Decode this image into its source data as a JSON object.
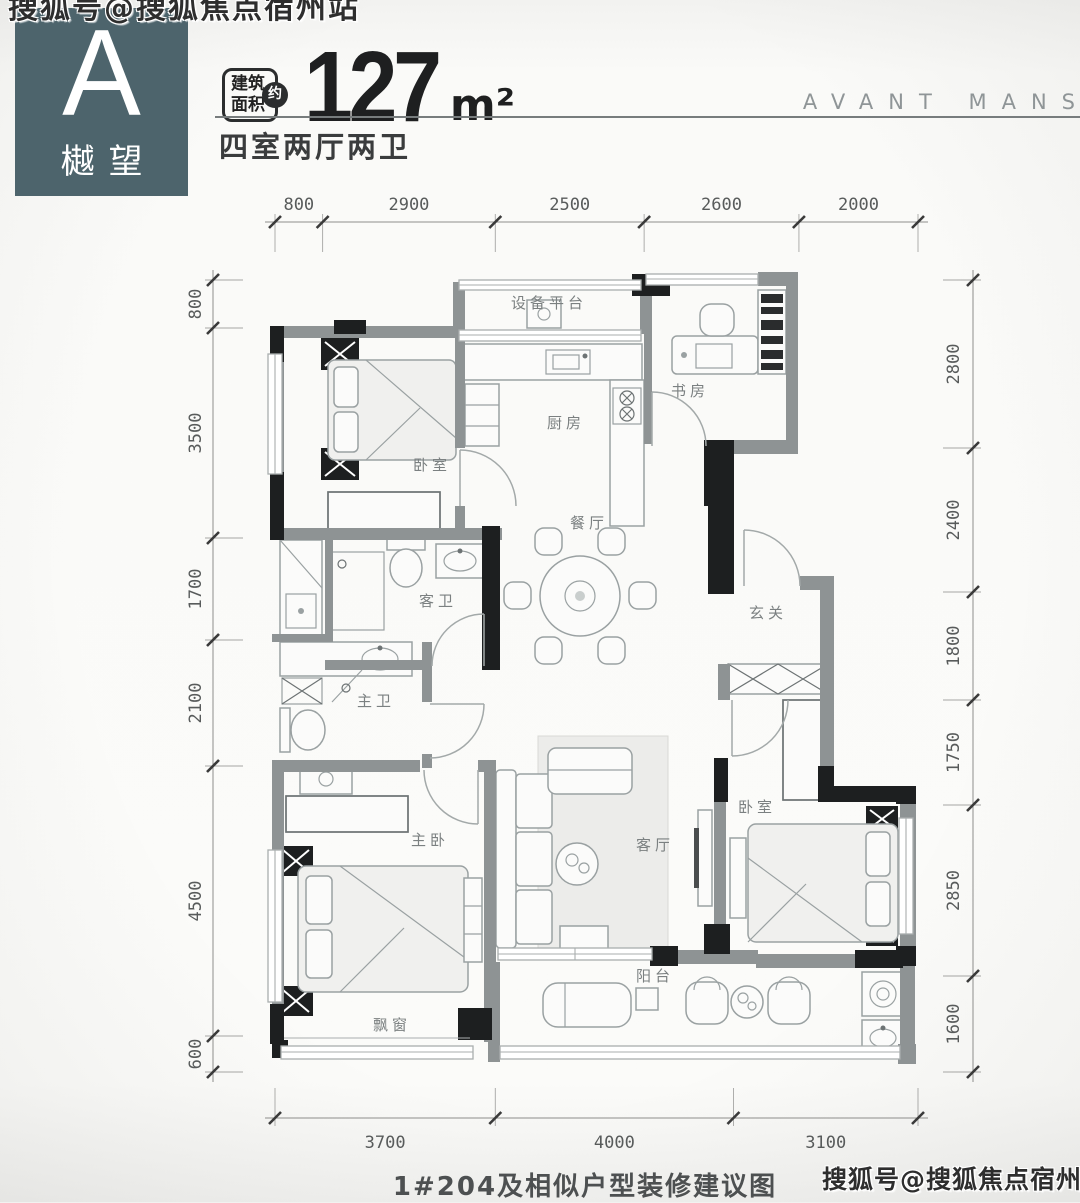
{
  "watermark": {
    "top_left": "搜狐号@搜狐焦点宿州站",
    "bottom_right": "搜狐号@搜狐焦点宿州站"
  },
  "header": {
    "unit_letter": "A",
    "unit_name": "樾望",
    "accent_color": "#4d646c",
    "area_badge": {
      "line1": "建筑",
      "line2": "面积",
      "circle": "约"
    },
    "area_value": "127",
    "area_unit": "m²",
    "layout_summary": "四室两厅两卫",
    "brand_text": "AVANT MANS"
  },
  "floor_plan": {
    "rooms": [
      {
        "id": "equipment-platform",
        "label": "设备平台",
        "x": 549,
        "y": 308
      },
      {
        "id": "bedroom-north",
        "label": "卧室",
        "x": 432,
        "y": 470
      },
      {
        "id": "kitchen",
        "label": "厨房",
        "x": 566,
        "y": 428
      },
      {
        "id": "study",
        "label": "书房",
        "x": 690,
        "y": 396
      },
      {
        "id": "dining",
        "label": "餐厅",
        "x": 589,
        "y": 528
      },
      {
        "id": "foyer",
        "label": "玄关",
        "x": 768,
        "y": 618
      },
      {
        "id": "guest-bath",
        "label": "客卫",
        "x": 438,
        "y": 606
      },
      {
        "id": "master-bath",
        "label": "主卫",
        "x": 376,
        "y": 706
      },
      {
        "id": "master-bedroom",
        "label": "主卧",
        "x": 430,
        "y": 845
      },
      {
        "id": "living",
        "label": "客厅",
        "x": 655,
        "y": 850
      },
      {
        "id": "bedroom-east",
        "label": "卧室",
        "x": 757,
        "y": 812
      },
      {
        "id": "balcony",
        "label": "阳台",
        "x": 655,
        "y": 981
      },
      {
        "id": "bay-window",
        "label": "飘窗",
        "x": 392,
        "y": 1030
      }
    ],
    "dimensions": {
      "top": [
        "800",
        "2900",
        "2500",
        "2600",
        "2000"
      ],
      "left": [
        "800",
        "3500",
        "1700",
        "2100",
        "4500",
        "600"
      ],
      "right": [
        "2800",
        "2400",
        "1800",
        "1750",
        "2850",
        "1600"
      ],
      "bottom": [
        "3700",
        "4000",
        "3100"
      ]
    }
  },
  "caption": "1#204及相似户型装修建议图"
}
